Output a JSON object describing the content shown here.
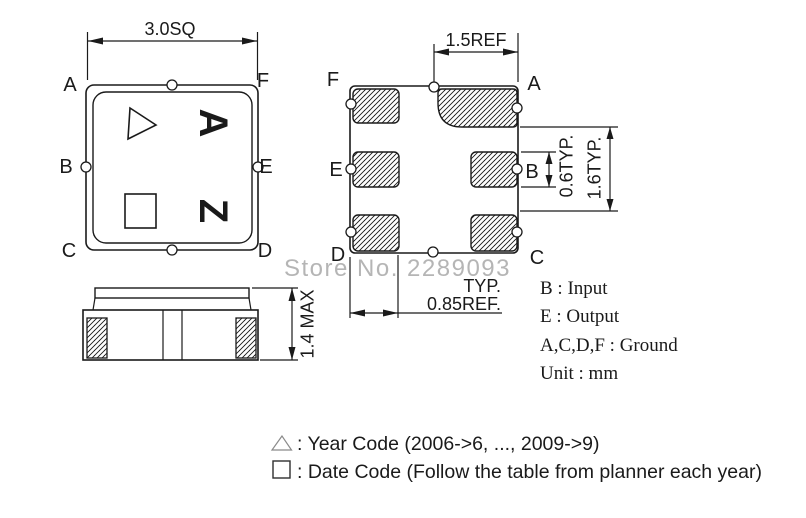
{
  "watermark": {
    "text": "Store No. 2289093",
    "color": "#b5b5b5"
  },
  "top_view": {
    "dim_size": "3.0SQ",
    "pin_top_left": "A",
    "pin_top_right": "F",
    "pin_mid_left": "B",
    "pin_mid_right": "E",
    "pin_bottom_left": "C",
    "pin_bottom_right": "D",
    "marking_letter_1": "A",
    "marking_letter_2": "Z"
  },
  "bottom_view": {
    "dim_top": "1.5REF",
    "dim_pad_height": "0.6TYP.",
    "dim_pad_span": "1.6TYP.",
    "dim_bottom_line1": "TYP.",
    "dim_bottom_line2": "0.85REF.",
    "pin_top_left": "F",
    "pin_top_right": "A",
    "pin_mid_left": "E",
    "pin_mid_right": "B",
    "pin_bottom_left": "D",
    "pin_bottom_right": "C"
  },
  "side_view": {
    "dim_height": "1.4 MAX"
  },
  "terminal_legend": {
    "line1": "B : Input",
    "line2": "E : Output",
    "line3": "A,C,D,F : Ground",
    "line4": "Unit : mm"
  },
  "marking_legend": {
    "year_code": ": Year Code (2006->6, ..., 2009->9)",
    "date_code": ": Date Code (Follow the table from planner each year)"
  }
}
